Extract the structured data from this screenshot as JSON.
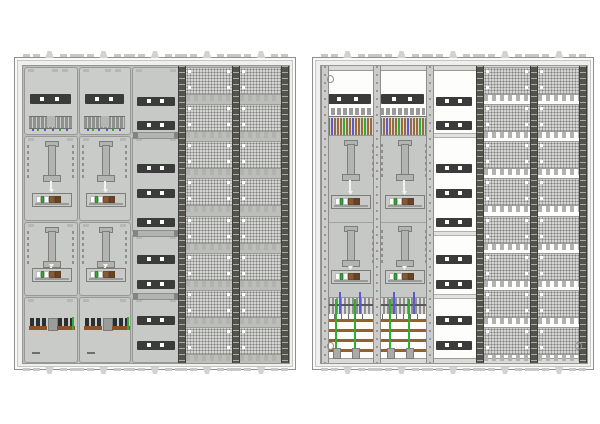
{
  "diagram": {
    "subject": "Two electrical meter distribution cabinets - covered field view and open frame view",
    "background": "#ffffff",
    "visible_text": []
  },
  "colors": {
    "frame_face": "#efefed",
    "frame_line": "#8f8f8f",
    "interior_covered": "#bcbeba",
    "interior_open": "#fdfdfc",
    "field_face": "#cbcdcb",
    "field_line": "#989896",
    "cover_panel": "#c7c9c7",
    "dark_strip": "#3b3b3b",
    "metal": "#b3b3b1",
    "metal_line": "#7d7d7b",
    "terminal_gray": "#909090",
    "device_dark": "#2e2e2e",
    "device_brown": "#8a5226",
    "busbar_brown": "#96602c",
    "wire_green": "#2fae2f",
    "wire_blue": "#5a5ad2",
    "wire_brown": "#9a6b3f",
    "perf_base": "#d4d4d2",
    "perf_dot": "#80807e",
    "comb_gray": "#b2b2b0",
    "rail_dark": "#54544c",
    "rail_light": "#cccccb"
  },
  "layout": {
    "cabinets_y": 57,
    "cabinet_width": 280,
    "cabinet_height": 311,
    "frame_pad": 7,
    "col_bounds": [
      0,
      55,
      108,
      158,
      212,
      266
    ],
    "row_bounds": [
      0,
      69,
      155,
      230,
      297
    ],
    "strip_column_sections": [
      [
        0,
        69
      ],
      [
        69,
        167
      ],
      [
        167,
        230
      ],
      [
        230,
        297
      ]
    ],
    "strip_ys": [
      31,
      55,
      98,
      123,
      152,
      189,
      214,
      250,
      275
    ],
    "perf_rows": 8,
    "mount_tab_count": 5
  },
  "cabinets": [
    {
      "id": "cabinet-a",
      "x": 14,
      "style": "covered"
    },
    {
      "id": "cabinet-b",
      "x": 312,
      "style": "open"
    }
  ],
  "left_cabinet": {
    "meter_columns": 2,
    "meter_rows": 2,
    "top_terminal_dots": [
      "blue",
      "green",
      "blue",
      "blue",
      "green",
      "blue"
    ]
  },
  "right_cabinet": {
    "meter_columns": 2,
    "meter_rows": 2,
    "top_stripe_pattern": [
      "brown",
      "brown",
      "blue",
      "brown",
      "brown",
      "brown",
      "green",
      "brown",
      "brown",
      "blue",
      "brown",
      "brown",
      "brown",
      "green",
      "brown",
      "brown"
    ],
    "busbar_count": 4
  },
  "meter_bracket_segments": [
    "#ffffff",
    "#2fae2f",
    "#ffffff",
    "#8a5a30",
    "#6b4322"
  ]
}
